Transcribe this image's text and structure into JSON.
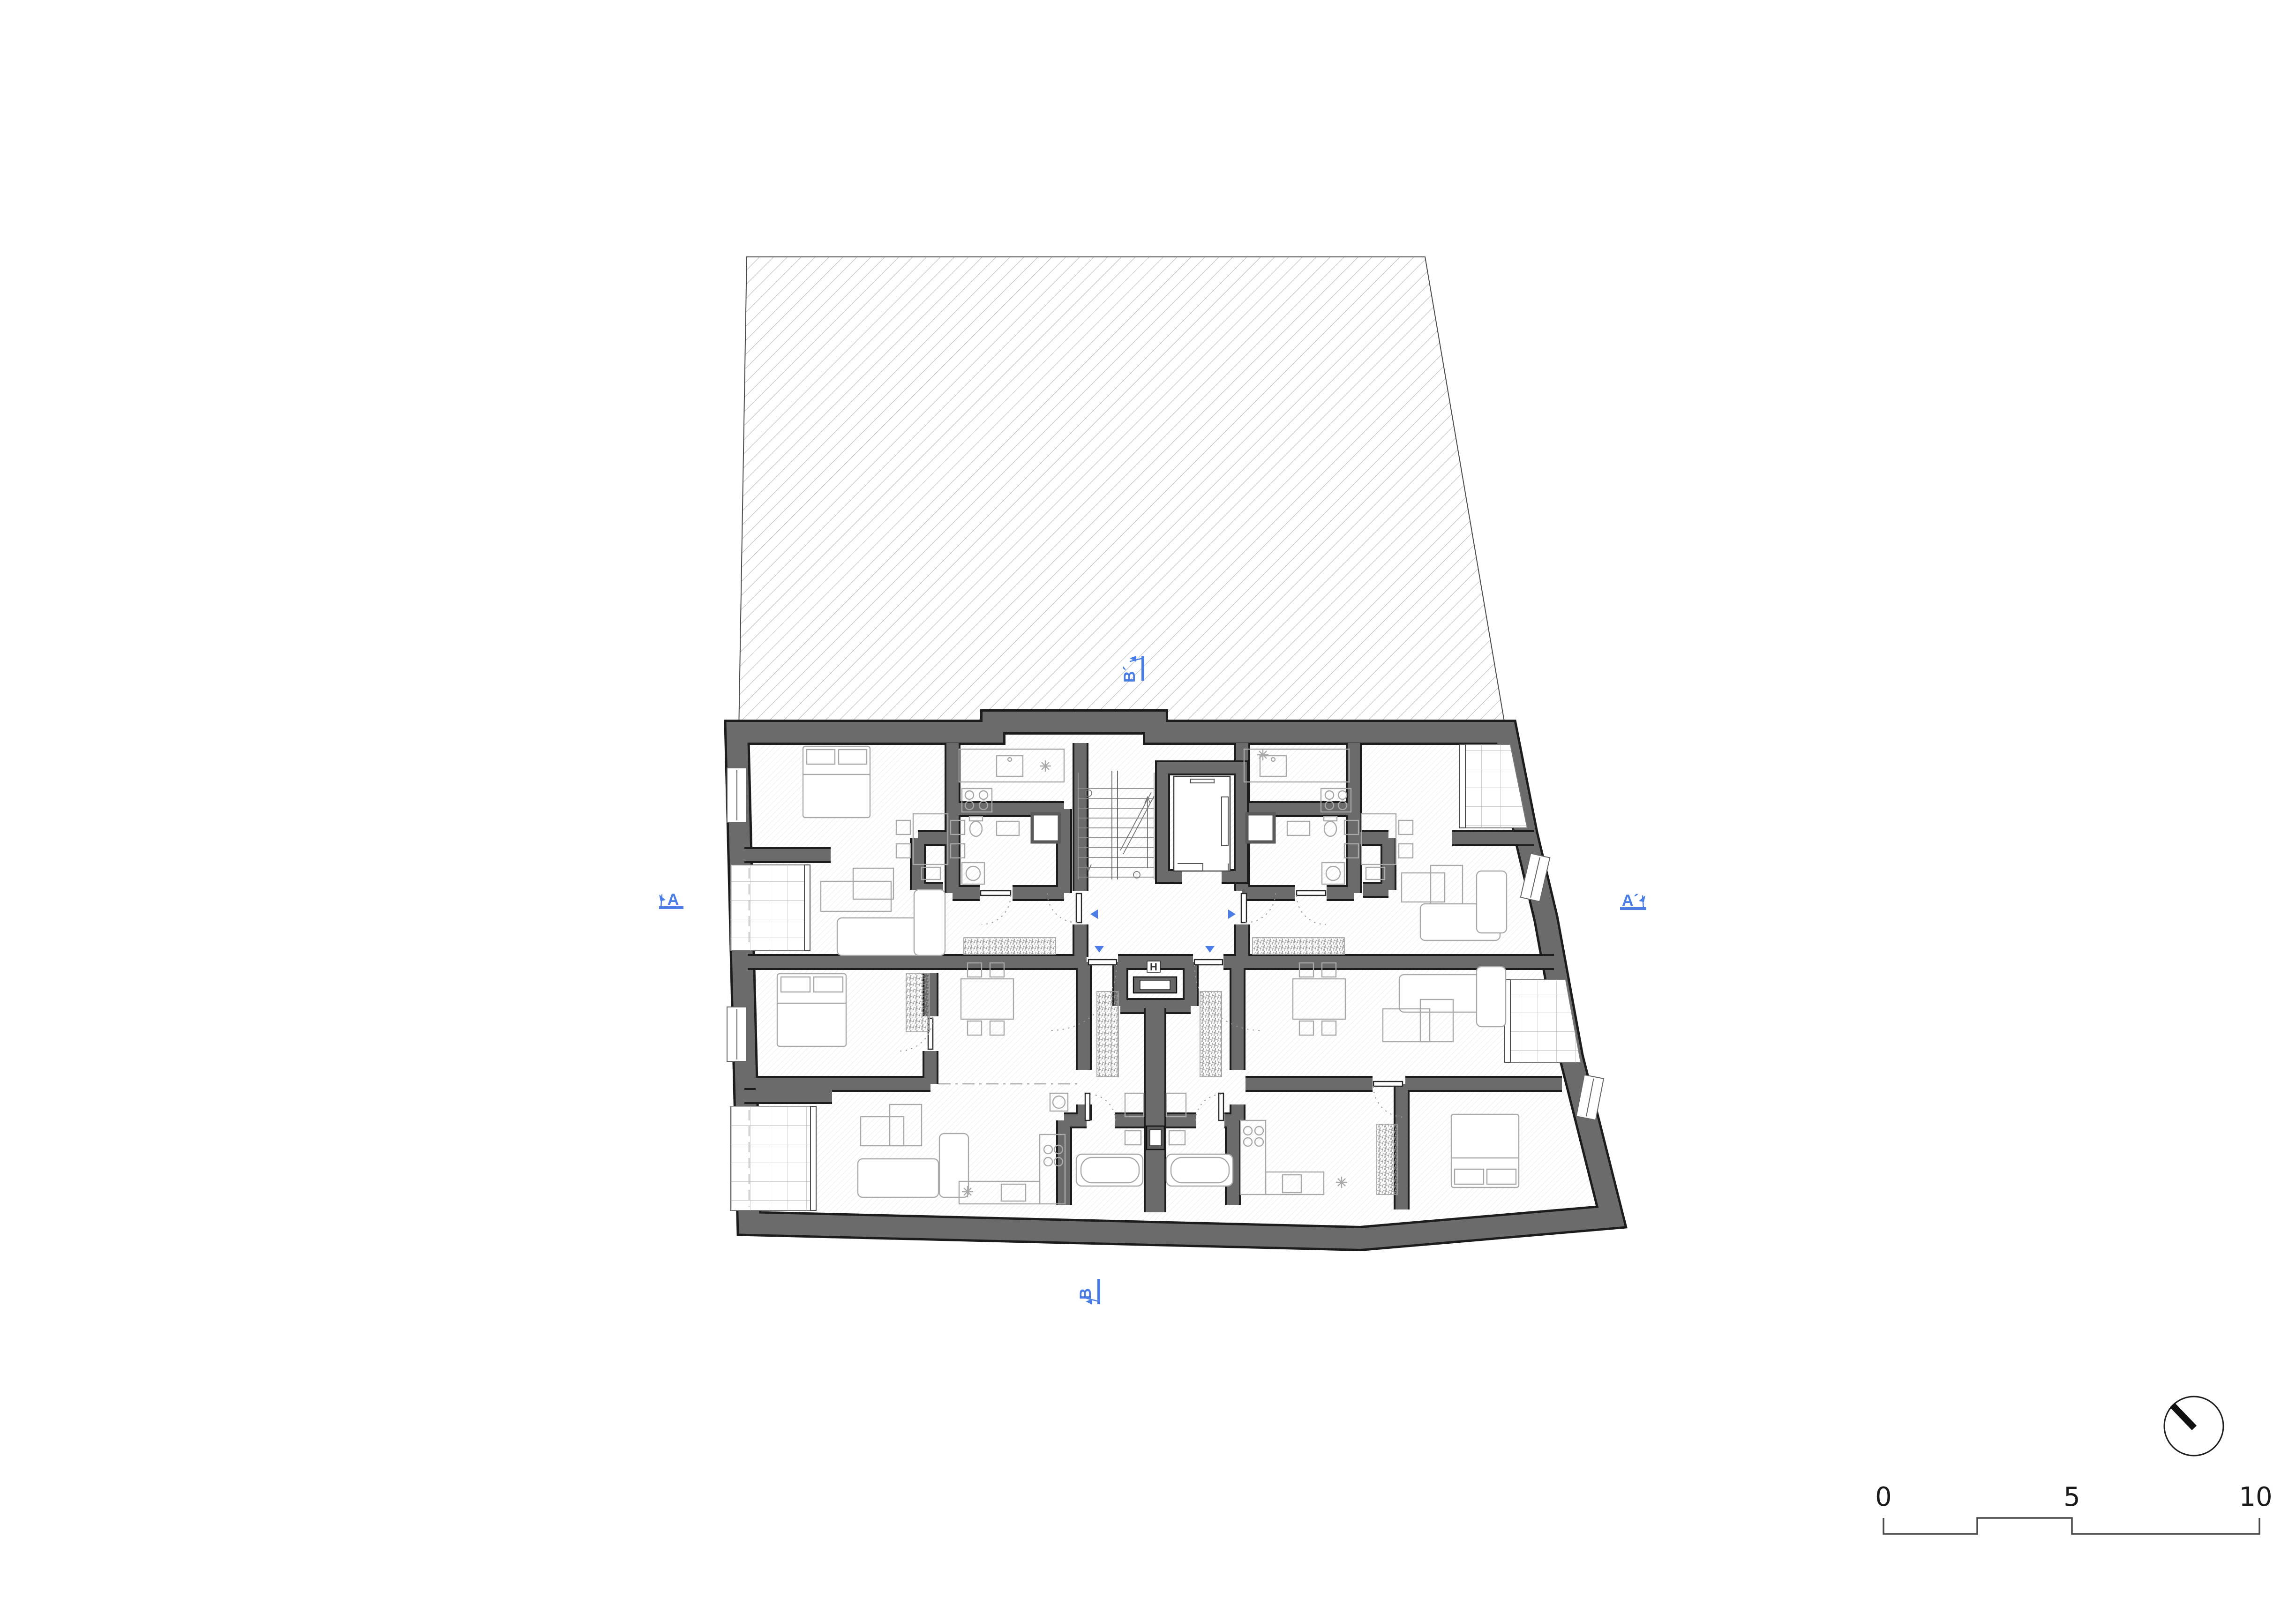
{
  "document": {
    "kind": "architectural floor plan drawing",
    "background": "#ffffff"
  },
  "colors": {
    "section_marker_blue": "#4a7de5",
    "wall_gray": "#6b6b6b",
    "wall_outline": "#1c1c1c",
    "site_hatch_gray": "#9a9a9a",
    "floor_hatch_gray": "#e3e3e3",
    "furniture_gray": "#a9a9a9",
    "balcony_tile_gray": "#b8b8b8"
  },
  "section_markers": {
    "top": {
      "label": "B´"
    },
    "bottom": {
      "label": "B"
    },
    "left": {
      "label": "A"
    },
    "right": {
      "label": "A´"
    }
  },
  "core": {
    "shaft_label": "H"
  },
  "scale_bar": {
    "tick_0": "0",
    "tick_5": "5",
    "tick_10": "10"
  },
  "icons": [
    "north-arrow-icon",
    "stair-icon",
    "elevator-icon"
  ]
}
